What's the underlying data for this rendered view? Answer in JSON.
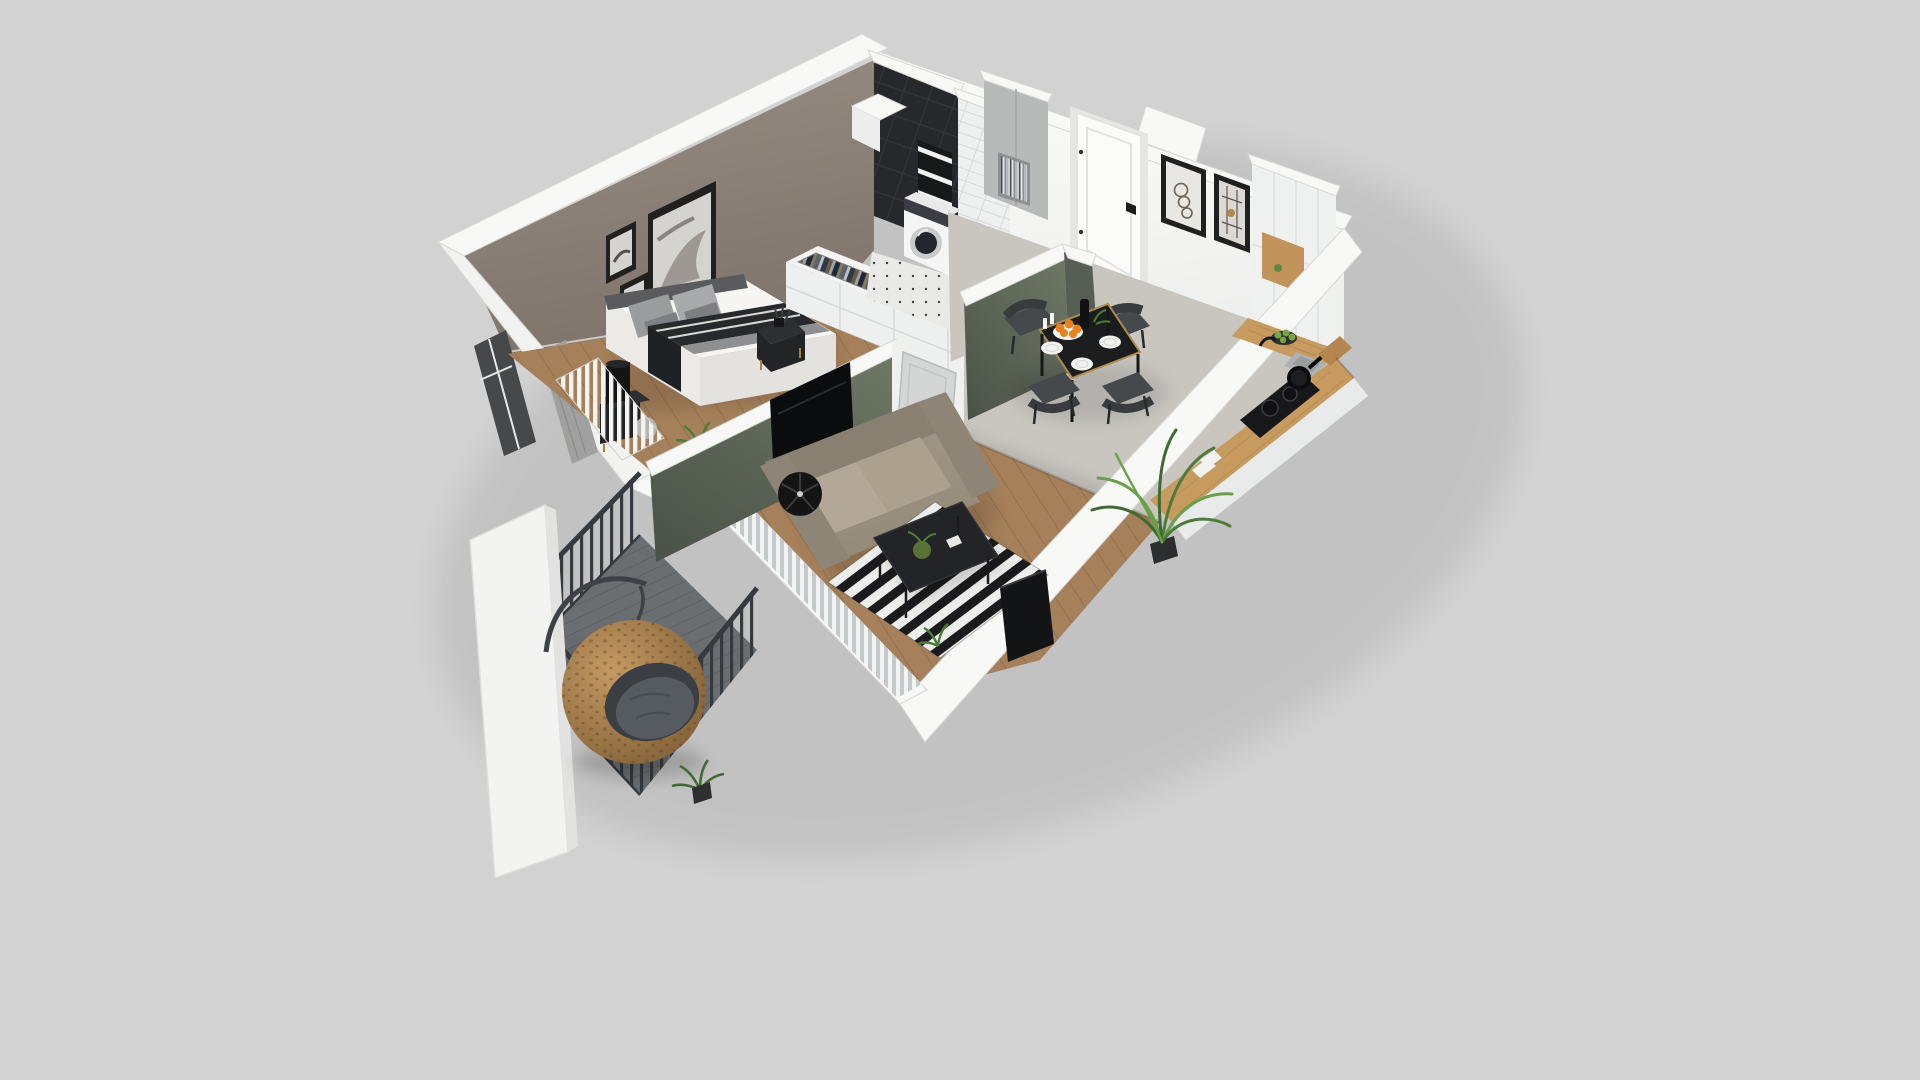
{
  "meta": {
    "description": "3D isometric cutaway render of a studio apartment floor plan on a plain light gray background. Rooms: bedroom with taupe accent wall, bed and wardrobe; bathroom with black tile, niche shelves and washing machine; entry hall with white door and two framed artworks; white kitchen with oak counter, cooktop and sink; dining set with black table and four dark chairs; living room with greige sofa, striped rug, coffee table and TV; balcony with hanging rattan egg chair and dark metal railing.",
    "canvas": {
      "width": 1920,
      "height": 1080
    }
  },
  "colors": {
    "background": "#d2d2d2",
    "wallTop": "#f8f8f6",
    "wallEdge": "#d8d8d6",
    "wallFace": "#fbfbf9",
    "taupeLight": "#988d83",
    "taupeDark": "#7f756c",
    "sageLight": "#6d7663",
    "sageDark": "#4a5148",
    "sageAlt": "#575f55",
    "woodFloor": "#a5805a",
    "kitchenFloor": "#c9c6c0",
    "bathFloor": "#e9e9e7",
    "balconyFloor": "#6a6e71",
    "blackTile": "#26282b",
    "subwayTile": "#eef0ef",
    "wardrobeWhite": "#eef0ef",
    "wardrobeTop": "#f4f5f3",
    "washerWhite": "#f4f5f4",
    "washerDrum": "#23272c",
    "washerRing": "#c9cccd",
    "machinePanel": "#3a3e44",
    "hallCabinet": "#b7bab9",
    "bookNiche": "#8e9192",
    "entryDoor": "#fbfbfa",
    "doorFrame": "#e6e6e4",
    "interiorDoor": "#d3d6d4",
    "pictureFrame": "#20201f",
    "artMatLight": "#e9e7e3",
    "artMatWarm": "#dcd9d4",
    "artPaper": "#d5d3cf",
    "kitchenCabinet": "#eff1f0",
    "oakNiche": "#c2945c",
    "counterOak": "#c79a5f",
    "counterBase": "#e9ebeb",
    "cuttingBoard": "#b3854f",
    "cooktop": "#17181a",
    "pan": "#0c0d0f",
    "sink": "#aeb2b3",
    "diningTable": "#1c1d1f",
    "goldTrim": "#b08d4f",
    "chair": "#45494c",
    "chairDark": "#383c3f",
    "plate": "#f2f2f0",
    "orangeFruit": "#e8821e",
    "bottle": "#121212",
    "greenApple": "#7aa545",
    "sofa": "#9b9081",
    "sofaBack": "#8a8071",
    "sofaCushion": "#b3a897",
    "sofaCushion2": "#aca18f",
    "sofaArm": "#8f8576",
    "lamp": "#141415",
    "coffeeTable": "#232427",
    "vase": "#5f7a36",
    "tv": "#0b0c0e",
    "tvBoard": "#131416",
    "rugDark": "#1b1b1d",
    "rugLight": "#ededeb",
    "curtainLight": "#f2f3f3",
    "curtainGray": "#c3c6c7",
    "bedroomCurtain": "#a0a09e",
    "railing": "#363a3e",
    "rattanLight": "#c59a63",
    "rattanDark": "#7c5a33",
    "eggOpening": "#3b3f44",
    "eggCushion": "#565b61",
    "plantGreen": "#4e7c38",
    "plantLight": "#69a04b",
    "plantDark": "#3f6b30",
    "pillowLight": "#a8aaac",
    "pillowGray": "#9a9c9e",
    "pillowDark": "#7d7f82",
    "throwDark": "#28292c",
    "throwGray": "#8e8f91",
    "windowGlass": "#46484a",
    "headboard": "#5a5b5e",
    "nightstand": "#232426",
    "bedWhite": "#f6f5f2",
    "clothes1": "#2e3a4c",
    "clothes2": "#c2bfb8",
    "clothes3": "#57636f",
    "clothes4": "#8a7a5d",
    "clothes5": "#1f2937",
    "clothes6": "#9aa1a8",
    "clothes7": "#6b5b43"
  },
  "rooms": [
    {
      "id": "bedroom",
      "objects": [
        "accent-wall",
        "gallery-frames",
        "double-bed",
        "pillows",
        "throw-blanket",
        "nightstand",
        "table-lamp",
        "radiator",
        "window",
        "curtain",
        "wardrobe-open-top"
      ]
    },
    {
      "id": "bathroom",
      "objects": [
        "black-tile-wall",
        "niche-shelves",
        "subway-tile-wall",
        "washing-machine",
        "tile-floor",
        "duct-shaft"
      ]
    },
    {
      "id": "entry-hall",
      "objects": [
        "entry-door",
        "framed-art-circles",
        "framed-art-geometric",
        "storage-cabinet",
        "book-shelf"
      ]
    },
    {
      "id": "kitchen",
      "objects": [
        "tall-cabinets",
        "oak-niche",
        "oak-counter",
        "cooktop",
        "pan",
        "sink",
        "faucet",
        "fruit-bowl",
        "palm-plant"
      ]
    },
    {
      "id": "dining-area",
      "objects": [
        "black-dining-table",
        "dining-chairs",
        "plates",
        "orange-bowl",
        "bottle"
      ]
    },
    {
      "id": "living-room",
      "objects": [
        "sage-partition-wall",
        "tv-panel",
        "sofa",
        "floor-lamp",
        "striped-rug",
        "coffee-table",
        "vase",
        "interior-door",
        "curtain-wall",
        "tv-sideboard"
      ]
    },
    {
      "id": "balcony",
      "objects": [
        "metal-railing",
        "plank-floor",
        "hanging-egg-chair",
        "egg-chair-stand",
        "potted-plant",
        "exterior-wall-slab"
      ]
    }
  ]
}
